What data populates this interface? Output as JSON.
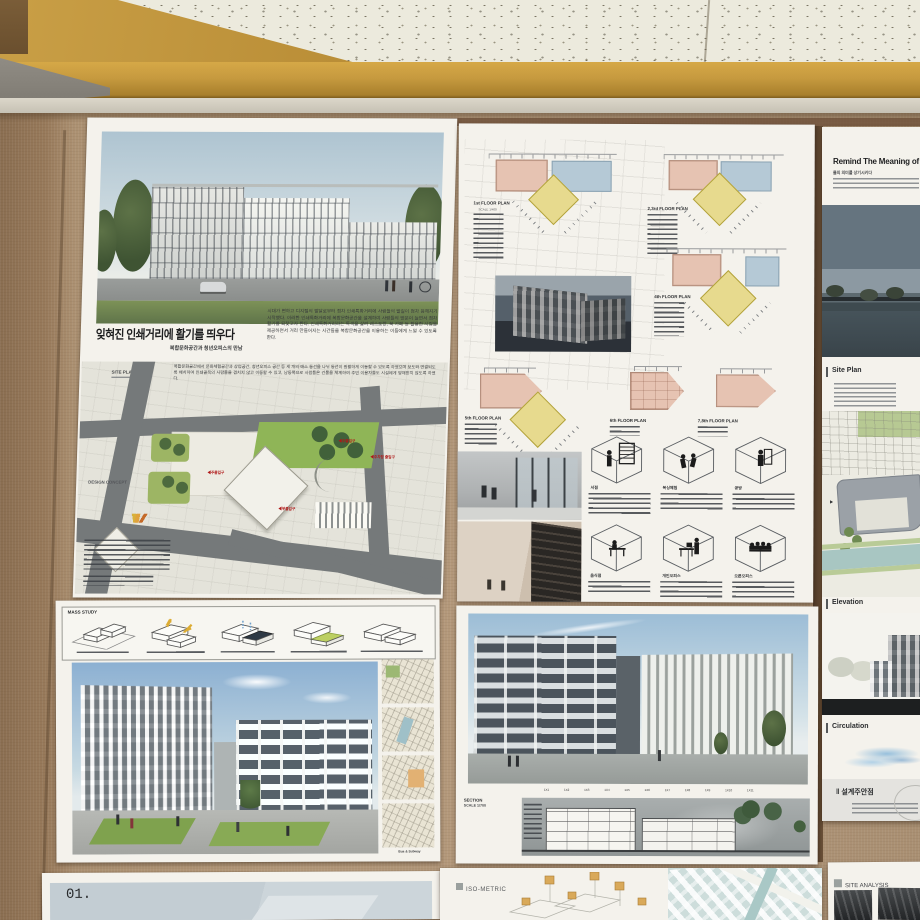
{
  "printing": {
    "title": "잊혀진 인쇄거리에 활기를 띄우다",
    "subtitle": "복합문화공간과 청년오피스의 만남",
    "intro": "시대가 변하고 디지털의 발달로부터 점차 인쇄특화거리에 사람들의 발길이 점차 뜸해지기 시작했다. 이러한 인쇄특화거리에 복합문화공간을 설계하여 사람들의 방문이 늘면서 점차 활기를 되찾고자 한다. 인쇄특화거리라는 특색을 살려 레스토랑, 북 카페 등 활용한 시집을 제공하면서 거리 만들어지는 시간들을 복합문화공간을 이용하는 이들에게 느낄 수 있도록 한다.",
    "site_text": "복합문화공간에서 문화체험공간과 상업공간, 청년오피스 공간 등 세 개의 매스 동선을 나뉘 동선이 원활하게 이동할 수 있도록 하였으며 보도와 연결되도록 배치하여 인쇄골목의 사람들을 겹치지 않고 이동할 수 있고, 남동쪽으로 사람들은 건물을 체계하여 주민 이용자들도 시설에게 방해받지 않도록 하였다.",
    "site_plan_label": "SITE PLAN",
    "design_concept_label": "DESIGN CONCEPT",
    "marker_main": "◀주출입구",
    "marker_sub": "◀부출입구",
    "marker_parking": "◀주차장 출입구"
  },
  "plans": {
    "plan1_title": "1st FLOOR PLAN",
    "plan23_title": "2,3rd FLOOR PLAN",
    "plan4_title": "4th FLOOR PLAN",
    "plan5_title": "5th FLOOR PLAN",
    "plan6_title": "6th FLOOR PLAN",
    "plan78_title": "7,8th FLOOR PLAN",
    "scale_label": "SCALE 1/400",
    "cube_labels": [
      "서점",
      "복싱체험",
      "공방",
      "음식점",
      "개인오피스",
      "오픈오피스"
    ]
  },
  "remind": {
    "title": "Remind The Meaning of",
    "subtitle": "물의 의미를 상기시키다",
    "site_plan_label": "Site Plan",
    "elevation_label": "Elevation",
    "circulation_label": "Circulation",
    "keypoints_label": "‖ 설계주안점"
  },
  "mass": {
    "label": "MASS STUDY"
  },
  "courtyard": {
    "map_caption": "Bus & Subway"
  },
  "sectionPoster": {
    "section_label": "SECTION",
    "scale_label": "SCALE 1/700",
    "grid_labels": [
      "1X1",
      "1X2",
      "1X3",
      "1X4",
      "1X5",
      "1X6",
      "1X7",
      "1X8",
      "1X9",
      "1X10",
      "1X11"
    ]
  },
  "iso": {
    "label": "ISO-METRIC"
  },
  "analysis": {
    "label": "SITE ANALYSIS"
  },
  "one": {
    "label": "01."
  },
  "colors": {
    "wall": "#ad9274",
    "wood_trim": "#c69a3f",
    "plan_pink": "#e6c3b2",
    "plan_blue": "#b5c9d6",
    "plan_yellow": "#e7da8e",
    "lawn_green": "#8fb557",
    "river_teal": "#a8c6c2",
    "marker_red": "#b01818",
    "sky": "#a9c4d6"
  }
}
